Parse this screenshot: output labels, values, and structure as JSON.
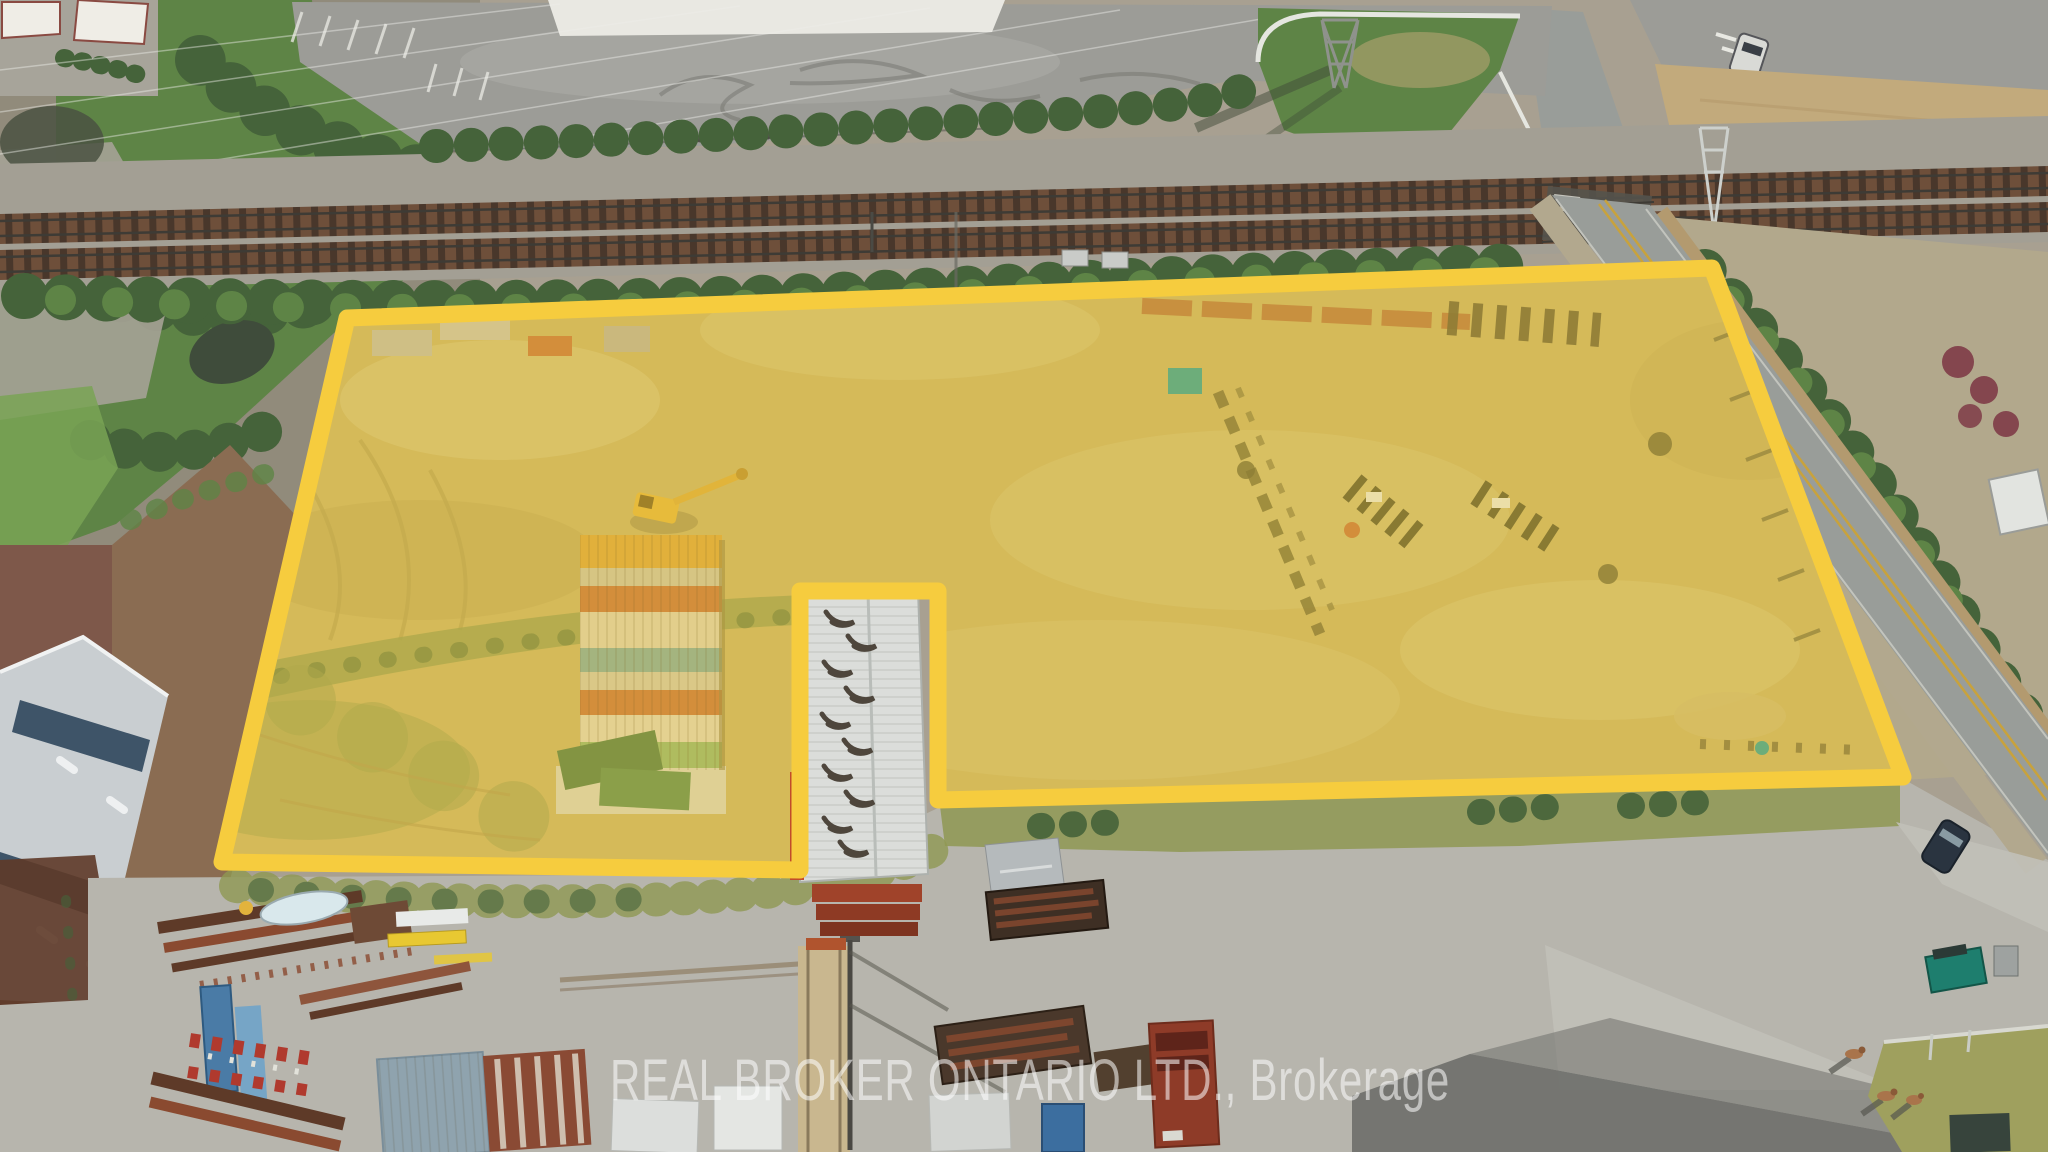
{
  "image": {
    "kind": "aerial-drone-photo",
    "description": "Aerial view of an industrial land parcel highlighted with a thick yellow boundary, bordered by a railway corridor to the north, a two-lane road to the east, a steel laydown yard to the south and vegetation to the west."
  },
  "watermark": {
    "text": "REAL BROKER ONTARIO LTD., Brokerage"
  },
  "parcel": {
    "highlight_opacity": 0.32,
    "boundary_stroke_width": 17
  },
  "features": [
    "railway-corridor",
    "level-crossing",
    "parking-lot",
    "tire-skid-marks",
    "transmission-tower",
    "guardrail",
    "highlighted-parcel",
    "parcel-boundary",
    "warehouse-building",
    "roof-vents",
    "shipping-container-stacks",
    "excavator",
    "steel-laydown-yard",
    "crane",
    "blue-roof-building",
    "roadway",
    "double-yellow-line",
    "car",
    "deer",
    "grass-island",
    "dumpster",
    "pond",
    "storage-tank",
    "watermark"
  ],
  "colors": {
    "base": "#A8A091",
    "topleft_ground": "#918B7B",
    "veg_dark": "#45633A",
    "veg_mid": "#5E8446",
    "veg_bright": "#79A355",
    "pond": "#3F4C3B",
    "lot": "#9C9C97",
    "white_pad": "#E9E8E2",
    "ballast": "#A39F94",
    "track_bed": "#6E4F3A",
    "tie": "#49372B",
    "rail": "#3E3B35",
    "road": "#999D99",
    "road_line_yellow": "#C8A23C",
    "dirt_tan": "#B2A88C",
    "dried_field": "#C2AA7C",
    "maroon_shrub": "#7E3B47",
    "dirt_red": "#7E584A",
    "dirt_brown": "#8A6C52",
    "building_roof": "#C9CED1",
    "building_stripe": "#3E5468",
    "concrete": "#B7B5AD",
    "shadow": "#6F706B",
    "rust": "#8A4A30",
    "rust_dark": "#5E3A28",
    "red_accent": "#B03A2E",
    "steel_blue": "#4A7BA6",
    "teal": "#2E9E98",
    "teal_machine": "#1E7E6E",
    "yellow_machine": "#E2B33C",
    "sand": "#C7B168",
    "sand_light": "#D8CA8E",
    "sand_dark": "#AE9A55",
    "olive": "#8F9852",
    "container_orange": "#C4703C",
    "container_yellow": "#D9A33B",
    "container_cream": "#DACFB2",
    "container_teal": "#7FA8A0",
    "container_green": "#8FB470",
    "container_dgreen": "#4E7A46",
    "warehouse_roof": "#DBDDDA",
    "vent": "#4E463C",
    "boundary": "#F6CC3E",
    "parcel_tint": "#F2CC3C",
    "watermark": "#FFFFFF",
    "car_dark": "#2A3440",
    "animal": "#A9744B"
  }
}
